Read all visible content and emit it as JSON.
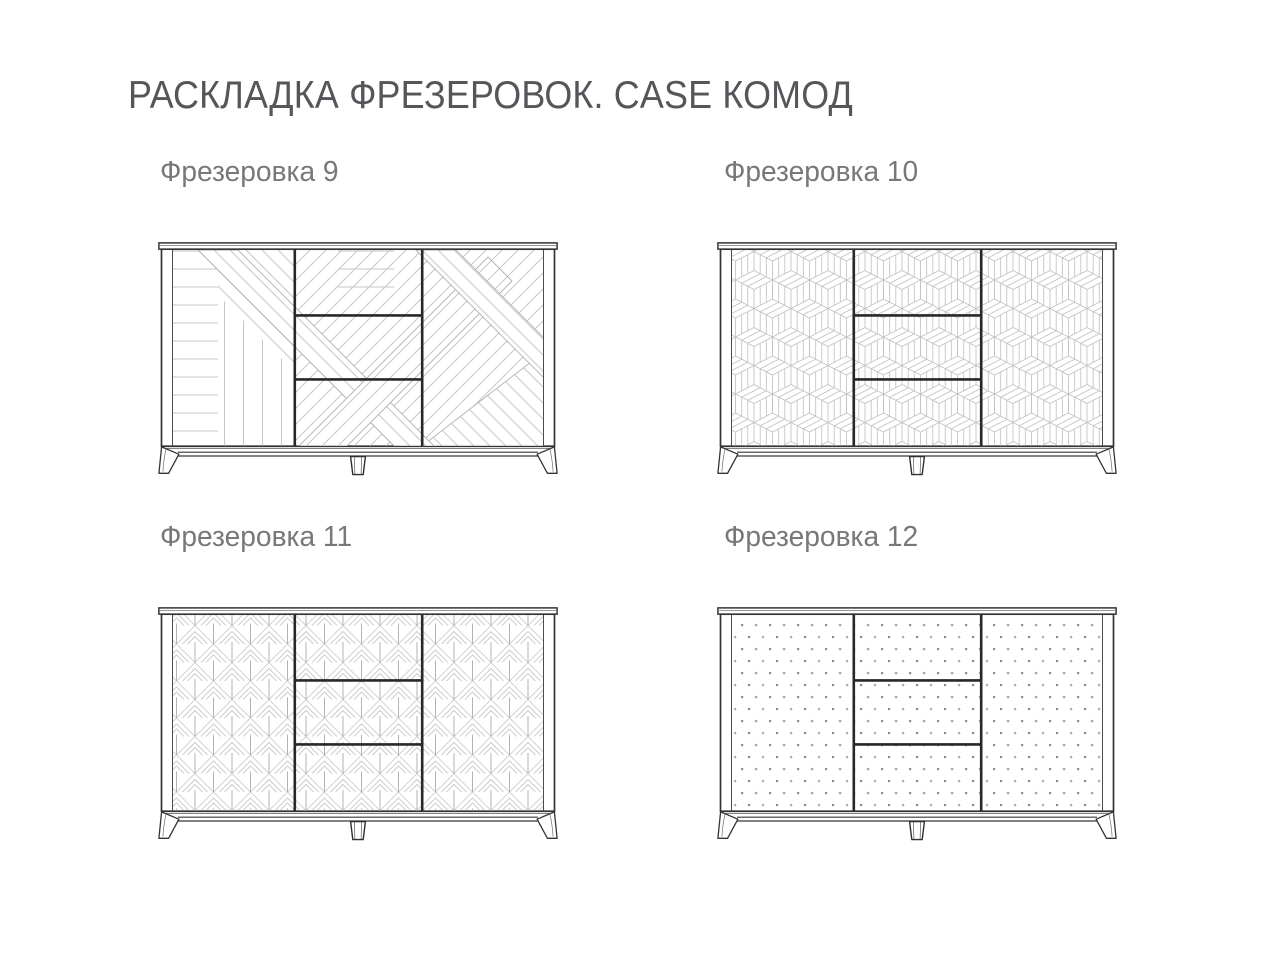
{
  "title": "РАСКЛАДКА ФРЕЗЕРОВОК. CASE КОМОД",
  "variants": [
    {
      "label": "Фрезеровка 9",
      "pattern": "diagonal-stripe-patchwork"
    },
    {
      "label": "Фрезеровка 10",
      "pattern": "isometric-cubes"
    },
    {
      "label": "Фрезеровка 11",
      "pattern": "nested-diamond-chevrons"
    },
    {
      "label": "Фрезеровка 12",
      "pattern": "dot-grid"
    }
  ],
  "cabinet": {
    "model": "CASE КОМОД",
    "sections": [
      "left-door",
      "drawer-stack",
      "right-door"
    ],
    "drawer_count": 3,
    "leg_count": 3
  },
  "colors": {
    "background": "#ffffff",
    "outline_dark": "#333436",
    "divider_thick": "#28282a",
    "pattern_line": "#c7c7c9",
    "band_edge": "#aeaeb0",
    "title_text": "#55565a",
    "label_text": "#77787b"
  }
}
